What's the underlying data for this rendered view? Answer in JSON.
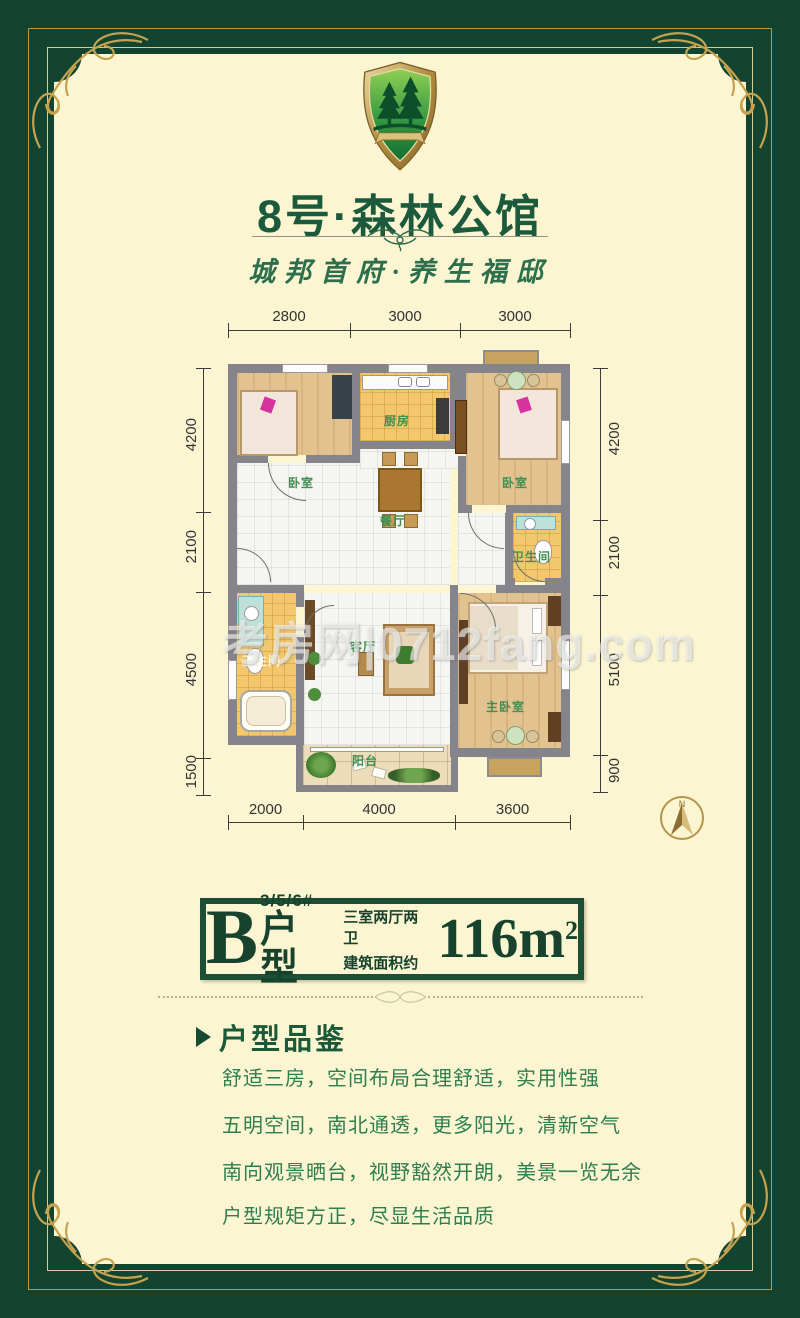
{
  "brand": {
    "name": "8号·森林公馆",
    "tagline": "城邦首府·养生福邸",
    "logo_icon": "pine-forest-shield-crest"
  },
  "watermark": "考房网|0712fang.com",
  "compass": {
    "north_label": "N"
  },
  "floor_plan": {
    "rooms": [
      {
        "id": "bedroom-left",
        "label": "卧室"
      },
      {
        "id": "kitchen",
        "label": "厨房"
      },
      {
        "id": "bedroom-right",
        "label": "卧室"
      },
      {
        "id": "dining-room",
        "label": "餐厅"
      },
      {
        "id": "bathroom-right",
        "label": "卫生间"
      },
      {
        "id": "bathroom-left",
        "label": "卫生间"
      },
      {
        "id": "living-room",
        "label": "客厅"
      },
      {
        "id": "master-bedroom",
        "label": "主卧室"
      },
      {
        "id": "balcony",
        "label": "阳台"
      }
    ],
    "dimensions_mm": {
      "top": [
        "2800",
        "3000",
        "3000"
      ],
      "bottom": [
        "2000",
        "4000",
        "3600"
      ],
      "left": [
        "4200",
        "2100",
        "4500",
        "1500"
      ],
      "right": [
        "4200",
        "2100",
        "5100",
        "900"
      ]
    }
  },
  "unit_badge": {
    "letter": "B",
    "buildings": "3/5/6#",
    "suffix": "户型",
    "layout": "三室两厅两卫",
    "area_prefix": "建筑面积约",
    "area_value": "116m",
    "area_exponent": "2"
  },
  "features": {
    "heading": "户型品鉴",
    "items": [
      "舒适三房，空间布局合理舒适，实用性强",
      "五明空间，南北通透，更多阳光，清新空气",
      "南向观景晒台，视野豁然开朗，美景一览无余",
      "户型规矩方正，尽显生活品质"
    ]
  },
  "colors": {
    "frame_green": "#124430",
    "panel_cream": "#fbf5d2",
    "gold": "#c2a257",
    "title_green": "#1b5a3c",
    "text_green": "#2f7e4f",
    "wall_gray": "#84848a",
    "wood_floor": "#e2c28e",
    "tile_orange": "#f3c76c"
  }
}
